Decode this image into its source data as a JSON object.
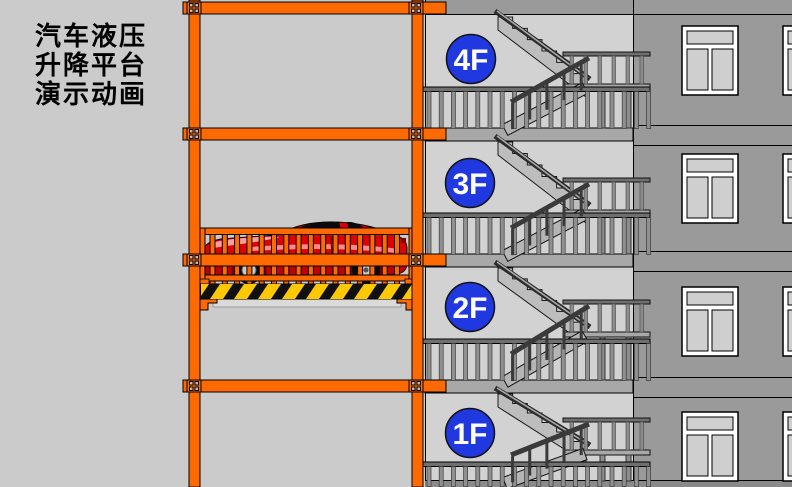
{
  "title": {
    "lines": [
      "汽车液压",
      "升降平台",
      "演示动画"
    ]
  },
  "floors": [
    {
      "label": "4F"
    },
    {
      "label": "3F"
    },
    {
      "label": "2F"
    },
    {
      "label": "1F"
    }
  ],
  "colors": {
    "background": "#CBCBCB",
    "stairwell_gray": "#D2D2D2",
    "wall_gray": "#9A9A9A",
    "slab_gray": "#A8A8A8",
    "frame_orange": "#FF6A00",
    "floor_badge_blue": "#2038DF",
    "badge_text_white": "#FFFFFF",
    "car_red": "#DE0000",
    "hazard_yellow": "#FFC800",
    "hazard_black": "#111111"
  }
}
